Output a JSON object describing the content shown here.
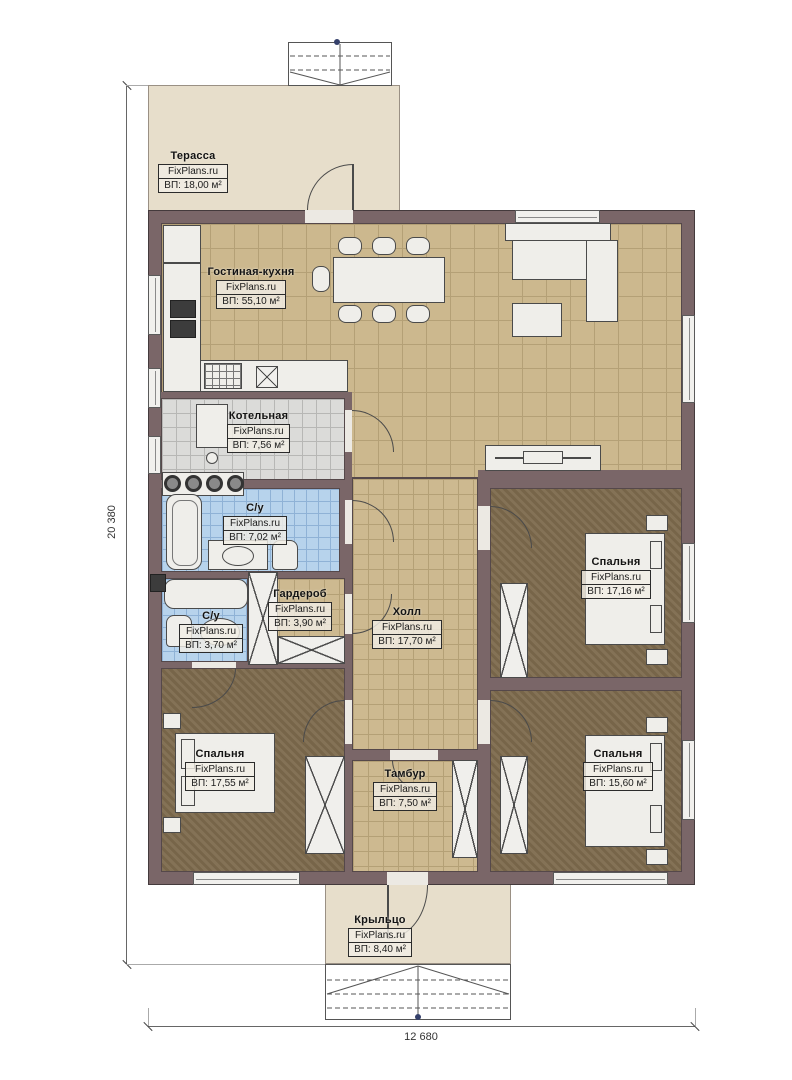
{
  "brand": "FixPlans.ru",
  "dimensions": {
    "height_label": "20 380",
    "width_label": "12 680"
  },
  "rooms": [
    {
      "id": "terrace",
      "name": "Терасса",
      "brand": "FixPlans.ru",
      "area": "ВП: 18,00 м²"
    },
    {
      "id": "living",
      "name": "Гостиная-кухня",
      "brand": "FixPlans.ru",
      "area": "ВП: 55,10 м²"
    },
    {
      "id": "boiler",
      "name": "Котельная",
      "brand": "FixPlans.ru",
      "area": "ВП: 7,56 м²"
    },
    {
      "id": "bath-1",
      "name": "С/у",
      "brand": "FixPlans.ru",
      "area": "ВП: 7,02 м²"
    },
    {
      "id": "wardrobe",
      "name": "Гардероб",
      "brand": "FixPlans.ru",
      "area": "ВП: 3,90 м²"
    },
    {
      "id": "bath-2",
      "name": "С/у",
      "brand": "FixPlans.ru",
      "area": "ВП: 3,70 м²"
    },
    {
      "id": "hall",
      "name": "Холл",
      "brand": "FixPlans.ru",
      "area": "ВП: 17,70 м²"
    },
    {
      "id": "bedroom-ne",
      "name": "Спальня",
      "brand": "FixPlans.ru",
      "area": "ВП: 17,16 м²"
    },
    {
      "id": "bedroom-sw",
      "name": "Спальня",
      "brand": "FixPlans.ru",
      "area": "ВП: 17,55 м²"
    },
    {
      "id": "bedroom-se",
      "name": "Спальня",
      "brand": "FixPlans.ru",
      "area": "ВП: 15,60 м²"
    },
    {
      "id": "tambour",
      "name": "Тамбур",
      "brand": "FixPlans.ru",
      "area": "ВП: 7,50 м²"
    },
    {
      "id": "porch",
      "name": "Крыльцо",
      "brand": "FixPlans.ru",
      "area": "ВП: 8,40 м²"
    }
  ],
  "colors": {
    "wall": "#7a6668",
    "living_floor": "#ccb88e",
    "bedroom_floor": "#7d6a4d",
    "boiler_floor": "#dbdbd9",
    "bathroom_floor": "#b7d3ec",
    "terrace_fill": "#e7decb"
  }
}
